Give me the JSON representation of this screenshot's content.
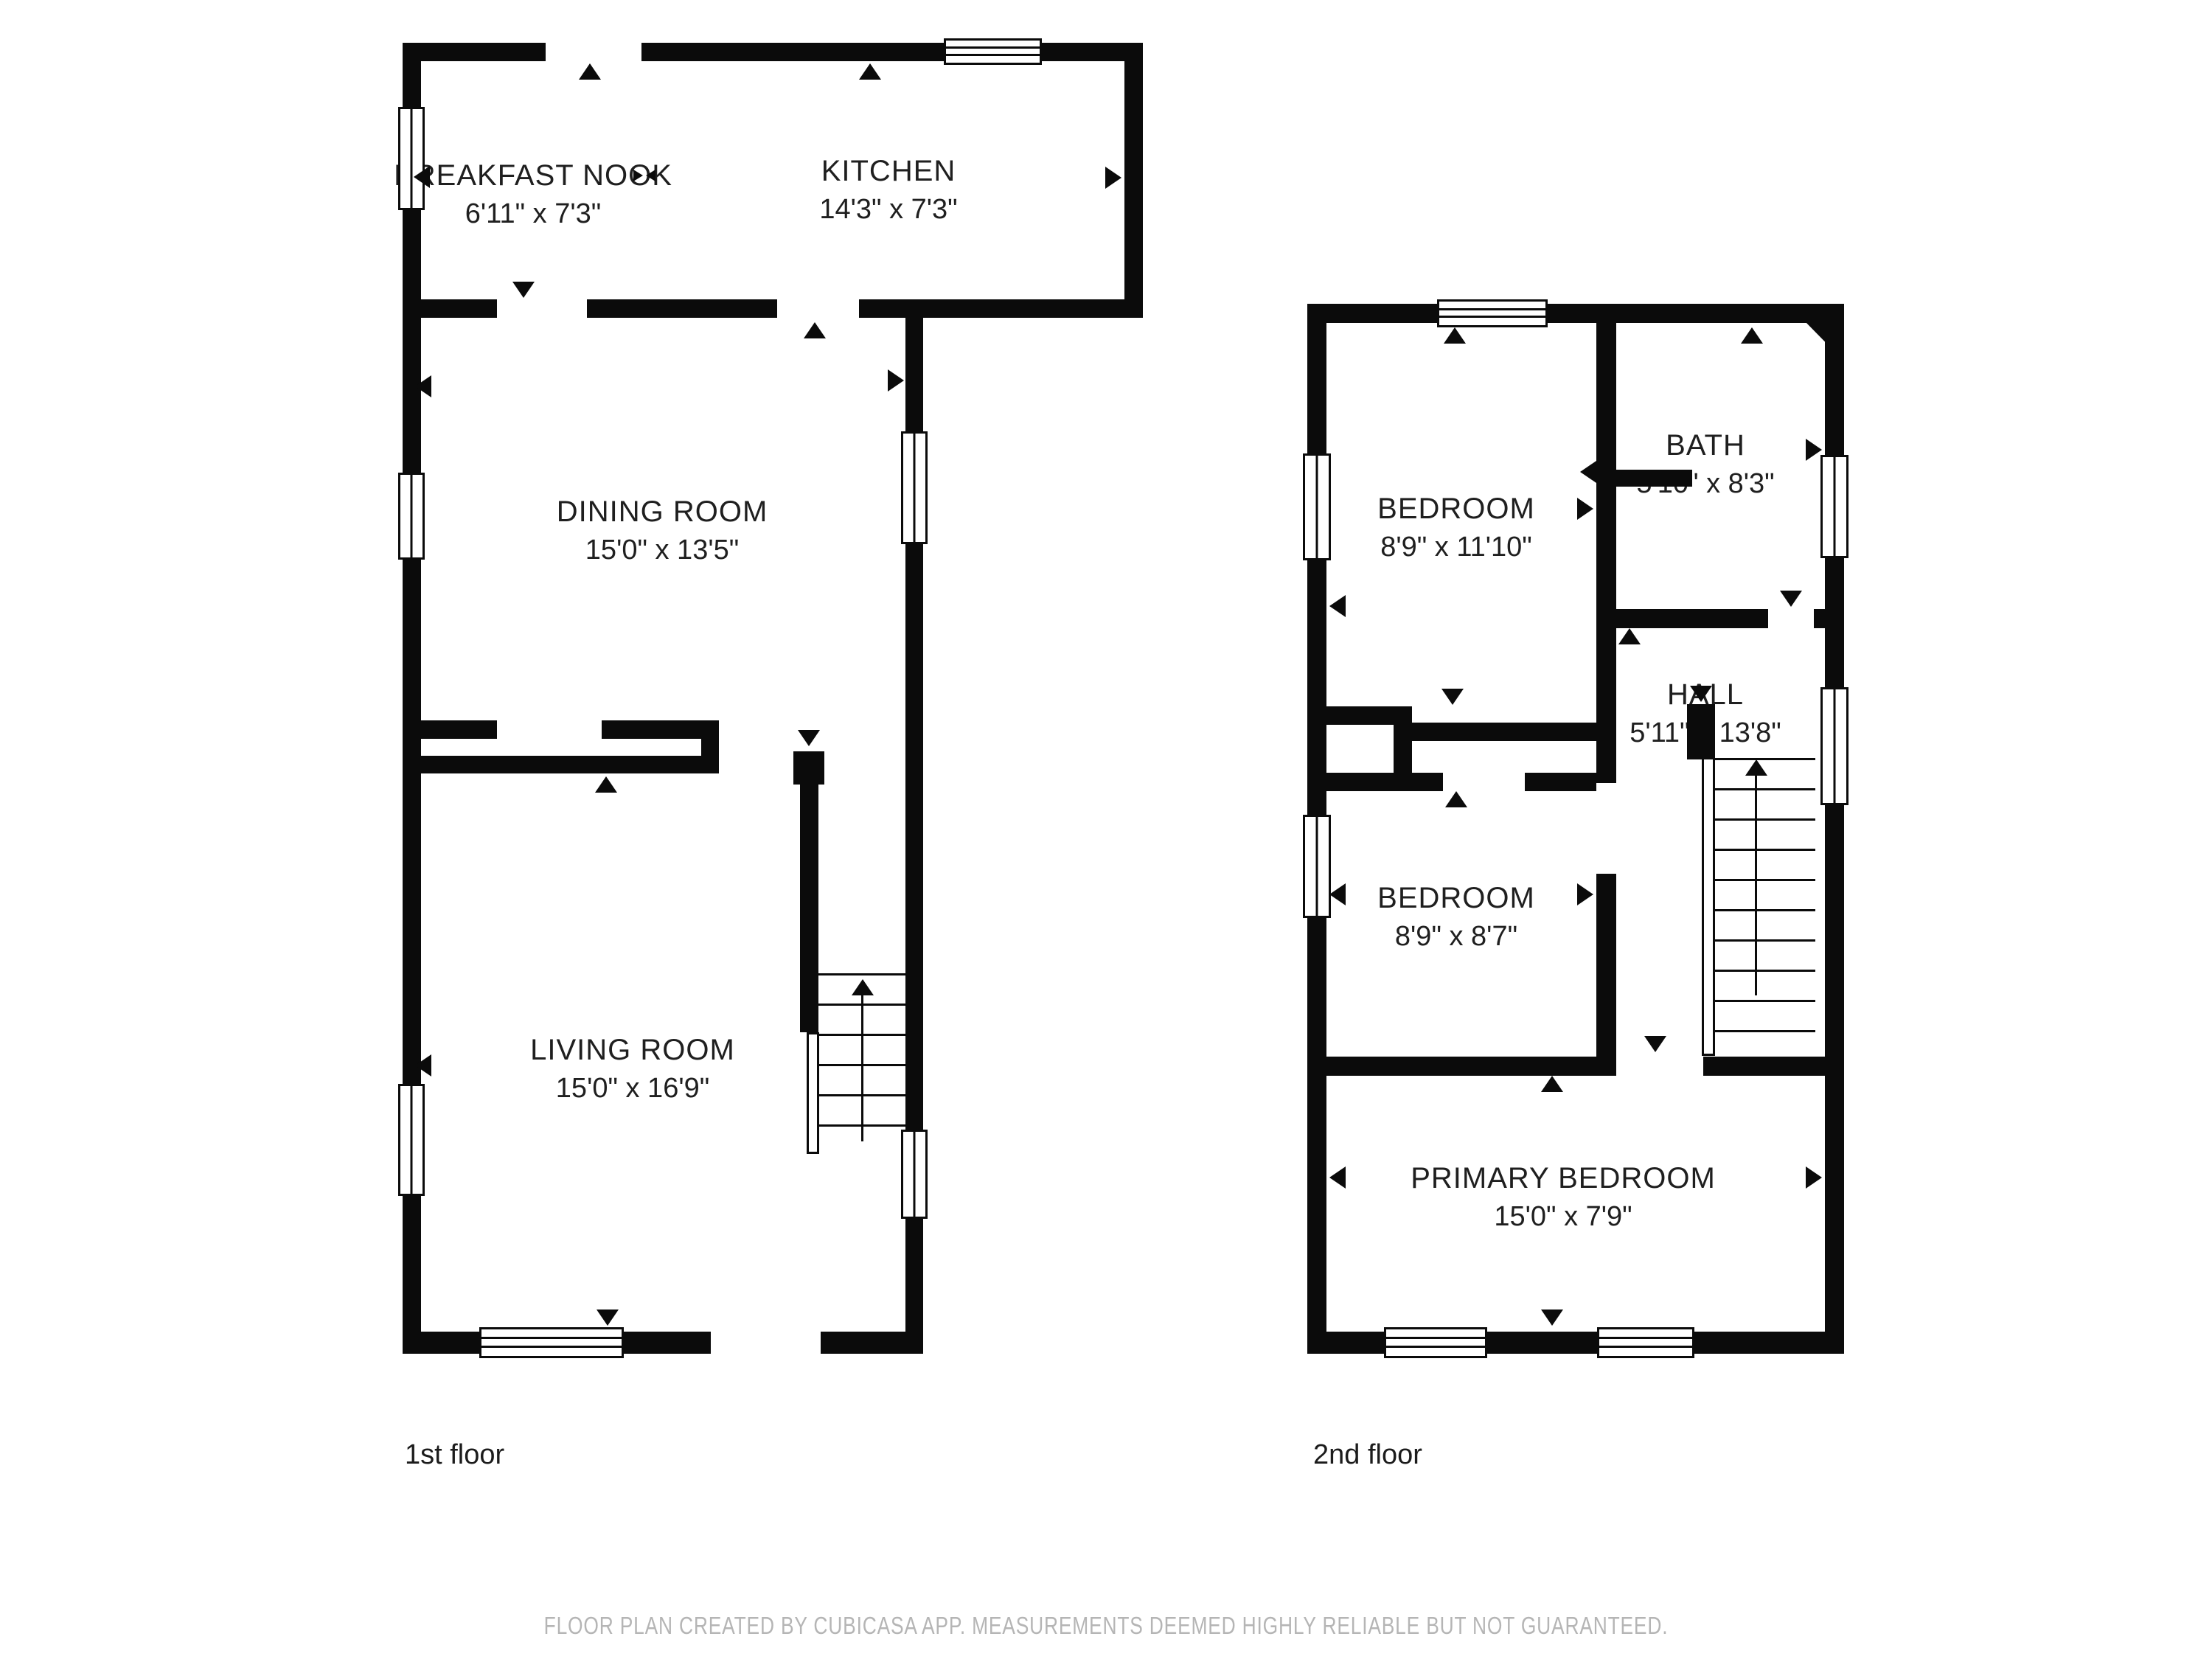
{
  "floors": [
    {
      "label": "1st floor",
      "rooms": [
        {
          "name": "BREAKFAST NOOK",
          "dims": "6'11\" x 7'3\""
        },
        {
          "name": "KITCHEN",
          "dims": "14'3\" x 7'3\""
        },
        {
          "name": "DINING ROOM",
          "dims": "15'0\" x 13'5\""
        },
        {
          "name": "LIVING ROOM",
          "dims": "15'0\" x 16'9\""
        }
      ]
    },
    {
      "label": "2nd floor",
      "rooms": [
        {
          "name": "BEDROOM",
          "dims": "8'9\" x 11'10\""
        },
        {
          "name": "BATH",
          "dims": "5'10\" x 8'3\""
        },
        {
          "name": "HALL",
          "dims": "5'11\" x 13'8\""
        },
        {
          "name": "BEDROOM",
          "dims": "8'9\" x 8'7\""
        },
        {
          "name": "PRIMARY BEDROOM",
          "dims": "15'0\" x 7'9\""
        }
      ]
    }
  ],
  "footer_text": "FLOOR PLAN CREATED BY CUBICASA APP. MEASUREMENTS DEEMED HIGHLY RELIABLE BUT NOT GUARANTEED.",
  "colors": {
    "wall": "#0b0b0b",
    "text": "#1f1f1f",
    "footer_text": "#b5b5b5",
    "background": "#ffffff"
  }
}
